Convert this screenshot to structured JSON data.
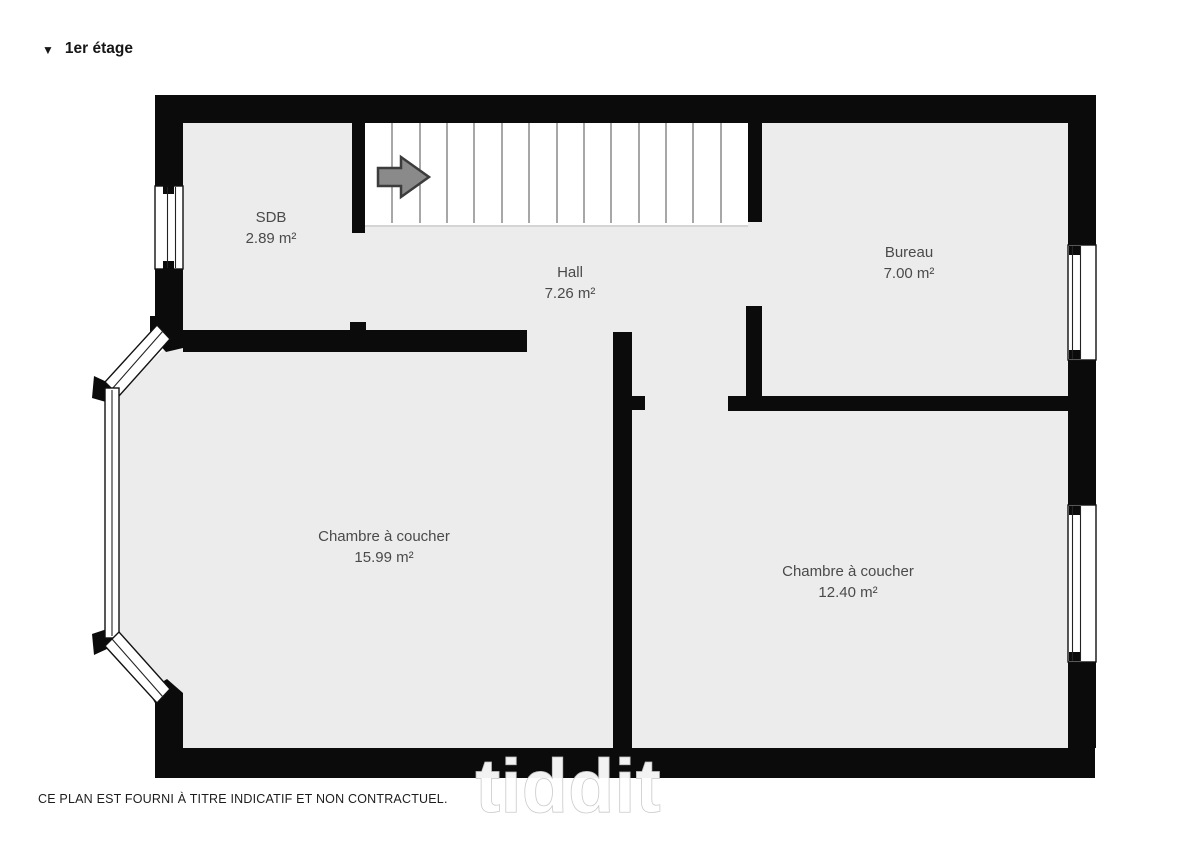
{
  "page": {
    "title": "1er étage",
    "collapse_icon": "▼",
    "disclaimer": "CE PLAN EST FOURNI À TITRE INDICATIF ET NON CONTRACTUEL.",
    "watermark": "tiddit"
  },
  "floor_plan": {
    "rooms": [
      {
        "name": "SDB",
        "area": "2.89 m²"
      },
      {
        "name": "Hall",
        "area": "7.26 m²"
      },
      {
        "name": "Bureau",
        "area": "7.00 m²"
      },
      {
        "name": "Chambre à coucher",
        "area": "15.99 m²"
      },
      {
        "name": "Chambre à coucher",
        "area": "12.40 m²"
      }
    ],
    "stairs": {
      "treads": 14,
      "direction_icon": "right-arrow"
    },
    "colors": {
      "wall": "#0b0b0b",
      "floor": "#ececec",
      "background": "#ffffff",
      "label": "#4a4a4a",
      "arrow_fill": "#8a8a8a",
      "arrow_stroke": "#3c3c3c",
      "tread_line": "#4f4f4f",
      "title": "#161616",
      "disclaimer": "#1d1d1d"
    }
  }
}
